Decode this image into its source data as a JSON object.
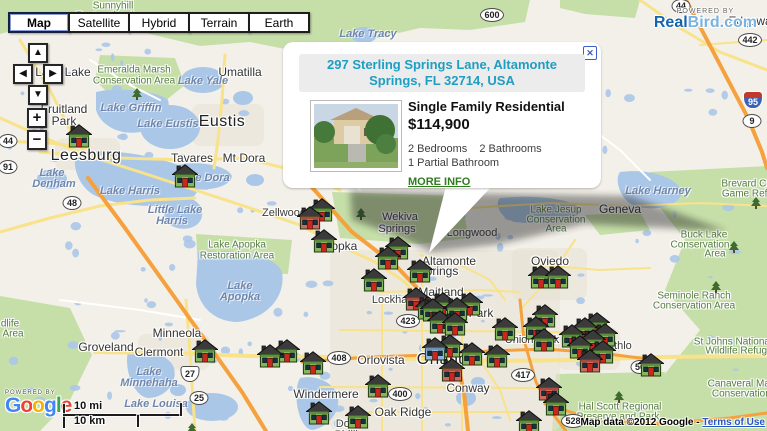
{
  "map_controls": {
    "map_types": [
      {
        "label": "Map",
        "active": true
      },
      {
        "label": "Satellite",
        "active": false
      },
      {
        "label": "Hybrid",
        "active": false
      },
      {
        "label": "Terrain",
        "active": false
      },
      {
        "label": "Earth",
        "active": false
      }
    ],
    "nav": {
      "up": "▲",
      "left": "◀",
      "right": "▶",
      "down": "▼",
      "zoom_in": "+",
      "zoom_out": "−"
    }
  },
  "branding": {
    "realbird_powered_by": "POWERED BY",
    "realbird_primary": "Real",
    "realbird_secondary": "Bird.com",
    "google_powered_by": "POWERED BY",
    "google_letters": [
      "G",
      "o",
      "o",
      "g",
      "l",
      "e"
    ],
    "google_colors": [
      "#4285F4",
      "#EA4335",
      "#F4B400",
      "#4285F4",
      "#34A853",
      "#EA4335"
    ]
  },
  "popup": {
    "address": "297 Sterling Springs Lane, Altamonte Springs, FL 32714, USA",
    "property_type": "Single Family Residential",
    "price": "$114,900",
    "bedrooms": "2 Bedrooms",
    "bathrooms": "2 Bathrooms",
    "partial_bathrooms": "1 Partial Bathroom",
    "more_info": "MORE INFO",
    "close": "✕"
  },
  "scale_bar": {
    "miles": "10 mi",
    "km": "10 km"
  },
  "attribution": {
    "text": "Map data ©2012 Google - ",
    "link": "Terms of Use"
  },
  "colors": {
    "land": "#f3f0e9",
    "water": "#abc7e8",
    "park": "#c6dfa8",
    "road_minor": "#ffffff",
    "road_arterial": "#f8e28a",
    "road_highway": "#f5a13d",
    "marker_green": "#86b45f",
    "marker_red": "#cf6a5f",
    "marker_blue": "#8fb7d9",
    "popup_accent": "#1e9ec2",
    "link_green": "#2f7c1f"
  },
  "map": {
    "city_labels": [
      {
        "t": "Lady Lake",
        "x": 63,
        "y": 72,
        "s": "town"
      },
      {
        "t": "Umatilla",
        "x": 240,
        "y": 72,
        "s": "town"
      },
      {
        "t": "Fruitland",
        "x": 64,
        "y": 109,
        "s": "town"
      },
      {
        "t": "Park",
        "x": 64,
        "y": 121,
        "s": "town"
      },
      {
        "t": "Eustis",
        "x": 222,
        "y": 122,
        "s": "big"
      },
      {
        "t": "Leesburg",
        "x": 86,
        "y": 156,
        "s": "big"
      },
      {
        "t": "Tavares",
        "x": 192,
        "y": 158,
        "s": "town"
      },
      {
        "t": "Mt Dora",
        "x": 244,
        "y": 158,
        "s": "town"
      },
      {
        "t": "Zellwood",
        "x": 284,
        "y": 213,
        "s": "city"
      },
      {
        "t": "Apopka",
        "x": 337,
        "y": 246,
        "s": "town"
      },
      {
        "t": "Wekiva",
        "x": 400,
        "y": 217,
        "s": "city"
      },
      {
        "t": "Springs",
        "x": 397,
        "y": 229,
        "s": "city"
      },
      {
        "t": "Longwood",
        "x": 472,
        "y": 233,
        "s": "city"
      },
      {
        "t": "Altamonte",
        "x": 449,
        "y": 261,
        "s": "town"
      },
      {
        "t": "Springs",
        "x": 438,
        "y": 271,
        "s": "town"
      },
      {
        "t": "Maitland",
        "x": 441,
        "y": 292,
        "s": "town"
      },
      {
        "t": "Winter Park",
        "x": 462,
        "y": 313,
        "s": "town"
      },
      {
        "t": "Lockhart",
        "x": 393,
        "y": 300,
        "s": "city"
      },
      {
        "t": "Orlando",
        "x": 447,
        "y": 360,
        "s": "big"
      },
      {
        "t": "Orlovista",
        "x": 381,
        "y": 360,
        "s": "town"
      },
      {
        "t": "Conway",
        "x": 468,
        "y": 388,
        "s": "town"
      },
      {
        "t": "Windermere",
        "x": 326,
        "y": 394,
        "s": "town"
      },
      {
        "t": "Oak Ridge",
        "x": 403,
        "y": 412,
        "s": "town"
      },
      {
        "t": "Doctor",
        "x": 352,
        "y": 424,
        "s": "city"
      },
      {
        "t": "Phillips",
        "x": 352,
        "y": 435,
        "s": "city"
      },
      {
        "t": "Minneola",
        "x": 177,
        "y": 333,
        "s": "town"
      },
      {
        "t": "Groveland",
        "x": 106,
        "y": 347,
        "s": "town"
      },
      {
        "t": "Clermont",
        "x": 159,
        "y": 352,
        "s": "town"
      },
      {
        "t": "Oviedo",
        "x": 550,
        "y": 261,
        "s": "town"
      },
      {
        "t": "Geneva",
        "x": 620,
        "y": 209,
        "s": "town"
      },
      {
        "t": "Bithlo",
        "x": 618,
        "y": 346,
        "s": "city"
      },
      {
        "t": "Union Park",
        "x": 532,
        "y": 340,
        "s": "city"
      },
      {
        "t": "Edgewater",
        "x": 757,
        "y": 21,
        "s": "town"
      }
    ],
    "water_labels": [
      {
        "t": "Lake Tracy",
        "x": 368,
        "y": 34
      },
      {
        "t": "Lake Yale",
        "x": 203,
        "y": 81
      },
      {
        "t": "Lake Griffin",
        "x": 131,
        "y": 108
      },
      {
        "t": "Lake Eustis",
        "x": 168,
        "y": 124
      },
      {
        "t": "Lake Dora",
        "x": 203,
        "y": 178
      },
      {
        "t": "Lake",
        "x": 52,
        "y": 173
      },
      {
        "t": "Denham",
        "x": 54,
        "y": 184
      },
      {
        "t": "Lake Harris",
        "x": 130,
        "y": 191
      },
      {
        "t": "Little Lake",
        "x": 175,
        "y": 210
      },
      {
        "t": "Harris",
        "x": 172,
        "y": 221
      },
      {
        "t": "Lake",
        "x": 240,
        "y": 286
      },
      {
        "t": "Apopka",
        "x": 240,
        "y": 297
      },
      {
        "t": "Lake",
        "x": 149,
        "y": 372
      },
      {
        "t": "Minnehaha",
        "x": 149,
        "y": 383
      },
      {
        "t": "Lake Louisa",
        "x": 156,
        "y": 404
      },
      {
        "t": "Lake Harney",
        "x": 658,
        "y": 191
      }
    ],
    "area_labels": [
      {
        "t": "Sunnyhill",
        "x": 113,
        "y": 6
      },
      {
        "t": "Restoration Area",
        "x": 113,
        "y": 16
      },
      {
        "t": "Emeralda Marsh",
        "x": 134,
        "y": 70
      },
      {
        "t": "Conservation Area",
        "x": 134,
        "y": 81
      },
      {
        "t": "Lake Apopka",
        "x": 237,
        "y": 245
      },
      {
        "t": "Restoration Area",
        "x": 237,
        "y": 256
      },
      {
        "t": "Lake Jesup",
        "x": 556,
        "y": 210
      },
      {
        "t": "Conservation",
        "x": 556,
        "y": 220
      },
      {
        "t": "Area",
        "x": 556,
        "y": 229
      },
      {
        "t": "Buck Lake",
        "x": 704,
        "y": 235
      },
      {
        "t": "Conservation",
        "x": 700,
        "y": 245
      },
      {
        "t": "Area",
        "x": 715,
        "y": 254
      },
      {
        "t": "Seminole Ranch",
        "x": 694,
        "y": 296
      },
      {
        "t": "Conservation Area",
        "x": 694,
        "y": 306
      },
      {
        "t": "St Johns National",
        "x": 733,
        "y": 342
      },
      {
        "t": "Wildlife Refuge",
        "x": 739,
        "y": 351
      },
      {
        "t": "Canaveral Marshes",
        "x": 751,
        "y": 384
      },
      {
        "t": "Conservation Area",
        "x": 753,
        "y": 394
      },
      {
        "t": "Hal Scott Regional",
        "x": 620,
        "y": 407
      },
      {
        "t": "Preserve and Park",
        "x": 618,
        "y": 417
      },
      {
        "t": "Brevard Co.",
        "x": 748,
        "y": 184
      },
      {
        "t": "Game Refuge",
        "x": 753,
        "y": 194
      },
      {
        "t": "dlife",
        "x": 10,
        "y": 324
      },
      {
        "t": "Area",
        "x": 13,
        "y": 334
      }
    ],
    "road_shields": [
      {
        "n": "600",
        "x": 492,
        "y": 15,
        "k": "oval"
      },
      {
        "n": "44",
        "x": 681,
        "y": 6,
        "k": "oval"
      },
      {
        "n": "442",
        "x": 750,
        "y": 40,
        "k": "oval"
      },
      {
        "n": "95",
        "x": 753,
        "y": 100,
        "k": "i"
      },
      {
        "n": "9",
        "x": 752,
        "y": 121,
        "k": "oval"
      },
      {
        "n": "44",
        "x": 8,
        "y": 141,
        "k": "oval"
      },
      {
        "n": "91",
        "x": 8,
        "y": 167,
        "k": "oval"
      },
      {
        "n": "48",
        "x": 72,
        "y": 203,
        "k": "oval"
      },
      {
        "n": "27",
        "x": 190,
        "y": 374,
        "k": "us"
      },
      {
        "n": "25",
        "x": 199,
        "y": 398,
        "k": "oval"
      },
      {
        "n": "423",
        "x": 408,
        "y": 321,
        "k": "oval"
      },
      {
        "n": "408",
        "x": 339,
        "y": 358,
        "k": "oval"
      },
      {
        "n": "400",
        "x": 400,
        "y": 394,
        "k": "oval"
      },
      {
        "n": "417",
        "x": 523,
        "y": 375,
        "k": "oval"
      },
      {
        "n": "528",
        "x": 573,
        "y": 421,
        "k": "oval"
      },
      {
        "n": "50",
        "x": 640,
        "y": 367,
        "k": "oval"
      }
    ],
    "trees": [
      {
        "x": 137,
        "y": 93
      },
      {
        "x": 361,
        "y": 213
      },
      {
        "x": 734,
        "y": 246
      },
      {
        "x": 716,
        "y": 286
      },
      {
        "x": 619,
        "y": 396
      },
      {
        "x": 756,
        "y": 202
      },
      {
        "x": 192,
        "y": 428
      }
    ],
    "markers": [
      {
        "x": 79,
        "y": 136,
        "c": "g"
      },
      {
        "x": 185,
        "y": 176,
        "c": "g"
      },
      {
        "x": 322,
        "y": 210,
        "c": "g"
      },
      {
        "x": 310,
        "y": 218,
        "c": "r"
      },
      {
        "x": 324,
        "y": 241,
        "c": "g"
      },
      {
        "x": 398,
        "y": 248,
        "c": "g"
      },
      {
        "x": 388,
        "y": 258,
        "c": "g"
      },
      {
        "x": 374,
        "y": 280,
        "c": "g"
      },
      {
        "x": 420,
        "y": 271,
        "c": "g"
      },
      {
        "x": 416,
        "y": 299,
        "c": "r"
      },
      {
        "x": 433,
        "y": 310,
        "c": "g"
      },
      {
        "x": 205,
        "y": 351,
        "c": "g"
      },
      {
        "x": 270,
        "y": 356,
        "c": "g"
      },
      {
        "x": 287,
        "y": 351,
        "c": "g"
      },
      {
        "x": 313,
        "y": 363,
        "c": "g"
      },
      {
        "x": 319,
        "y": 413,
        "c": "g"
      },
      {
        "x": 358,
        "y": 417,
        "c": "g"
      },
      {
        "x": 378,
        "y": 386,
        "c": "g"
      },
      {
        "x": 428,
        "y": 308,
        "c": "g"
      },
      {
        "x": 443,
        "y": 304,
        "c": "g"
      },
      {
        "x": 457,
        "y": 309,
        "c": "g"
      },
      {
        "x": 470,
        "y": 304,
        "c": "g"
      },
      {
        "x": 440,
        "y": 322,
        "c": "g"
      },
      {
        "x": 455,
        "y": 324,
        "c": "g"
      },
      {
        "x": 435,
        "y": 349,
        "c": "b"
      },
      {
        "x": 450,
        "y": 346,
        "c": "g"
      },
      {
        "x": 452,
        "y": 370,
        "c": "r"
      },
      {
        "x": 472,
        "y": 354,
        "c": "g"
      },
      {
        "x": 497,
        "y": 356,
        "c": "g"
      },
      {
        "x": 541,
        "y": 277,
        "c": "g"
      },
      {
        "x": 558,
        "y": 277,
        "c": "g"
      },
      {
        "x": 505,
        "y": 329,
        "c": "g"
      },
      {
        "x": 536,
        "y": 328,
        "c": "g"
      },
      {
        "x": 545,
        "y": 316,
        "c": "g"
      },
      {
        "x": 544,
        "y": 340,
        "c": "g"
      },
      {
        "x": 572,
        "y": 336,
        "c": "g"
      },
      {
        "x": 585,
        "y": 329,
        "c": "g"
      },
      {
        "x": 597,
        "y": 324,
        "c": "g"
      },
      {
        "x": 580,
        "y": 347,
        "c": "g"
      },
      {
        "x": 593,
        "y": 341,
        "c": "g"
      },
      {
        "x": 605,
        "y": 335,
        "c": "g"
      },
      {
        "x": 590,
        "y": 361,
        "c": "r"
      },
      {
        "x": 603,
        "y": 352,
        "c": "g"
      },
      {
        "x": 651,
        "y": 365,
        "c": "g"
      },
      {
        "x": 549,
        "y": 389,
        "c": "r"
      },
      {
        "x": 556,
        "y": 404,
        "c": "g"
      },
      {
        "x": 529,
        "y": 422,
        "c": "g"
      }
    ]
  }
}
